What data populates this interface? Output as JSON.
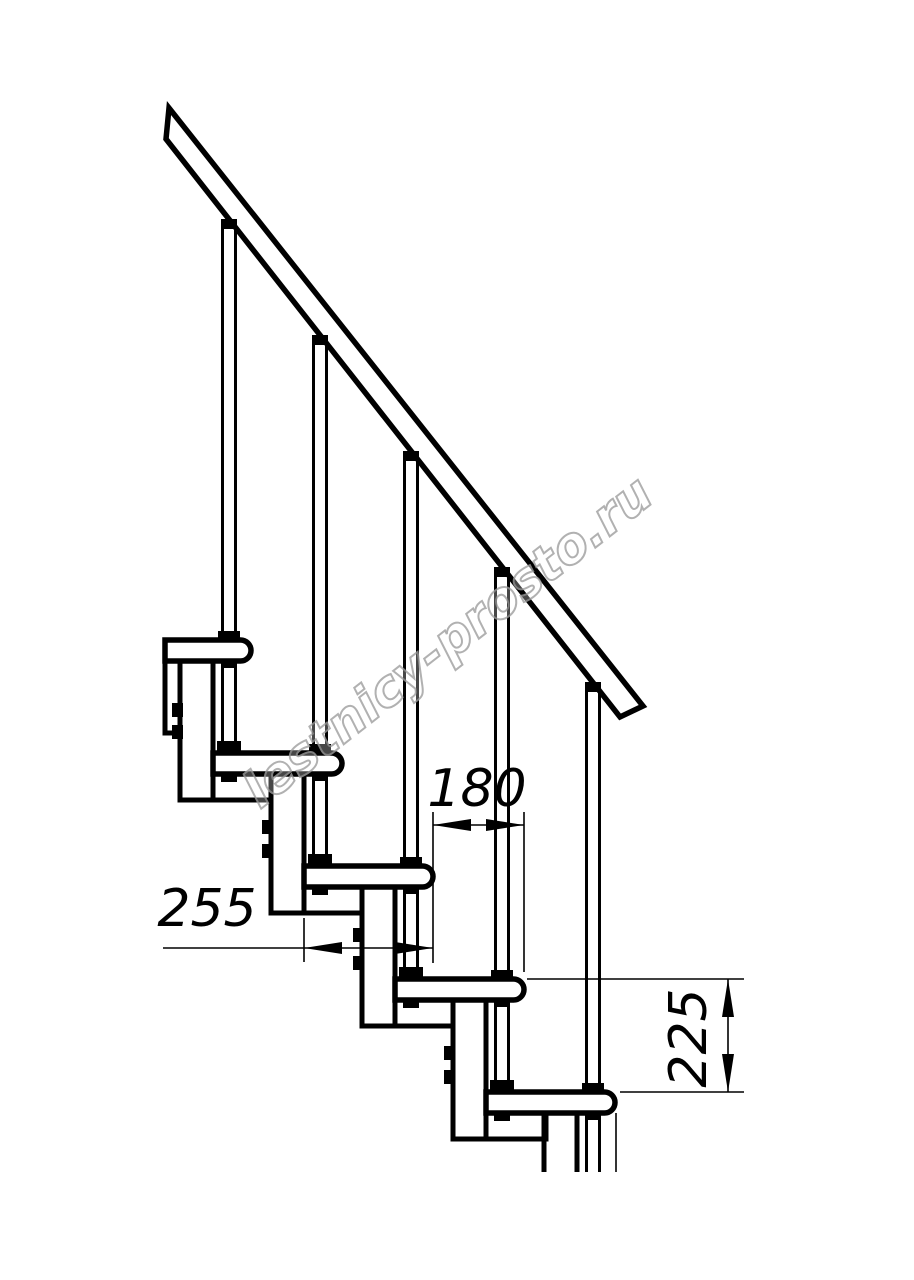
{
  "page": {
    "background": "#ffffff"
  },
  "drawing": {
    "type": "technical-line-drawing",
    "subject": "modular staircase side elevation with handrail",
    "line_color": "#000000",
    "watermark": {
      "text": "lestnicy-prosto.ru",
      "color": "#9e9e9e"
    },
    "dimensions": {
      "tread_depth": {
        "value": "255",
        "orientation": "horizontal"
      },
      "step_run": {
        "value": "180",
        "orientation": "horizontal"
      },
      "step_rise": {
        "value": "225",
        "orientation": "vertical"
      }
    }
  }
}
